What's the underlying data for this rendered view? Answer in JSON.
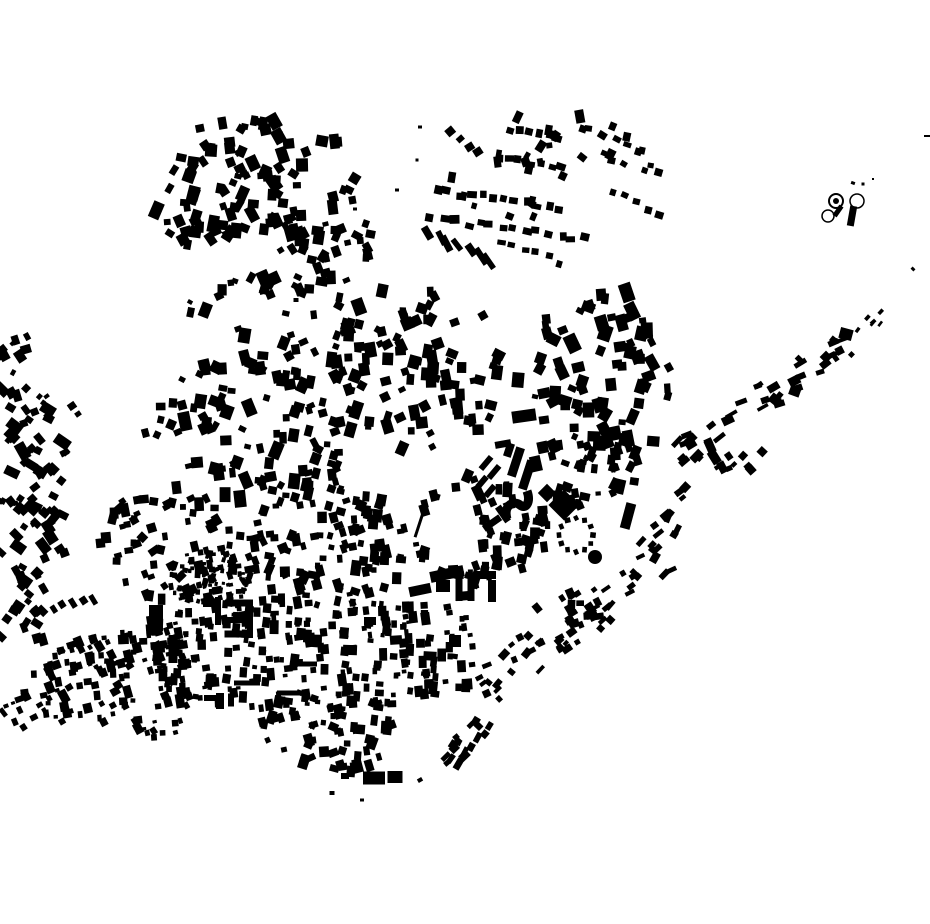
{
  "canvas": {
    "width": 930,
    "height": 924,
    "background": "#ffffff",
    "building_color": "#000000",
    "seed": 1337
  },
  "map": {
    "scatters": [
      {
        "shape": "ellipse",
        "cx": 255,
        "cy": 190,
        "rx": 105,
        "ry": 75,
        "n": 105,
        "smin": 6,
        "smax": 12,
        "ang": 0,
        "aj": 35
      },
      {
        "shape": "ellipse",
        "cx": 330,
        "cy": 240,
        "rx": 42,
        "ry": 36,
        "n": 22,
        "smin": 6,
        "smax": 11,
        "ang": 0,
        "aj": 35
      },
      {
        "shape": "ellipse",
        "cx": 545,
        "cy": 168,
        "rx": 115,
        "ry": 55,
        "n": 26,
        "smin": 5,
        "smax": 9,
        "ang": 10,
        "aj": 30
      },
      {
        "shape": "poly",
        "pts": [
          [
            0,
            330
          ],
          [
            28,
            332
          ],
          [
            62,
            432
          ],
          [
            76,
            520
          ],
          [
            60,
            640
          ],
          [
            0,
            640
          ]
        ],
        "n": 95,
        "smin": 5,
        "smax": 11,
        "ang": -40,
        "aj": 25
      },
      {
        "shape": "poly",
        "pts": [
          [
            8,
            700
          ],
          [
            70,
            638
          ],
          [
            185,
            618
          ],
          [
            192,
            744
          ],
          [
            25,
            716
          ]
        ],
        "n": 140,
        "smin": 4,
        "smax": 9,
        "ang": -15,
        "aj": 18
      },
      {
        "shape": "ellipse",
        "cx": 300,
        "cy": 330,
        "rx": 120,
        "ry": 58,
        "n": 55,
        "smin": 6,
        "smax": 12,
        "ang": 0,
        "aj": 30
      },
      {
        "shape": "ellipse",
        "cx": 255,
        "cy": 430,
        "rx": 110,
        "ry": 70,
        "n": 90,
        "smin": 6,
        "smax": 12,
        "ang": 0,
        "aj": 30
      },
      {
        "shape": "ellipse",
        "cx": 420,
        "cy": 370,
        "rx": 90,
        "ry": 80,
        "n": 85,
        "smin": 6,
        "smax": 12,
        "ang": 0,
        "aj": 30
      },
      {
        "shape": "ellipse",
        "cx": 600,
        "cy": 380,
        "rx": 72,
        "ry": 95,
        "n": 78,
        "smin": 6,
        "smax": 13,
        "ang": 0,
        "aj": 30
      },
      {
        "shape": "ellipse",
        "cx": 180,
        "cy": 545,
        "rx": 85,
        "ry": 60,
        "n": 70,
        "smin": 5,
        "smax": 10,
        "ang": -10,
        "aj": 25
      },
      {
        "shape": "ellipse",
        "cx": 210,
        "cy": 578,
        "rx": 46,
        "ry": 28,
        "n": 90,
        "smin": 3,
        "smax": 6,
        "ang": 0,
        "aj": 20
      },
      {
        "shape": "ellipse",
        "cx": 330,
        "cy": 545,
        "rx": 80,
        "ry": 65,
        "n": 105,
        "smin": 5,
        "smax": 10,
        "ang": 0,
        "aj": 25
      },
      {
        "shape": "ellipse",
        "cx": 480,
        "cy": 530,
        "rx": 70,
        "ry": 55,
        "n": 70,
        "smin": 5,
        "smax": 10,
        "ang": 0,
        "aj": 25,
        "hole": {
          "cx": 452,
          "cy": 530,
          "rx": 30,
          "ry": 33
        }
      },
      {
        "shape": "poly",
        "pts": [
          [
            148,
            612
          ],
          [
            250,
            598
          ],
          [
            360,
            600
          ],
          [
            470,
            608
          ],
          [
            478,
            660
          ],
          [
            468,
            700
          ],
          [
            300,
            712
          ],
          [
            165,
            705
          ],
          [
            146,
            660
          ]
        ],
        "n": 265,
        "smin": 4,
        "smax": 9,
        "ang": 0,
        "aj": 10
      },
      {
        "shape": "ellipse",
        "cx": 330,
        "cy": 730,
        "rx": 75,
        "ry": 45,
        "n": 65,
        "smin": 5,
        "smax": 10,
        "ang": 0,
        "aj": 25
      },
      {
        "shape": "ellipse",
        "cx": 590,
        "cy": 468,
        "rx": 55,
        "ry": 44,
        "n": 42,
        "smin": 5,
        "smax": 11,
        "ang": 0,
        "aj": 30
      },
      {
        "shape": "ellipse",
        "cx": 560,
        "cy": 602,
        "rx": 45,
        "ry": 33,
        "n": 16,
        "smin": 5,
        "smax": 9,
        "ang": -20,
        "aj": 25
      },
      {
        "shape": "ellipse",
        "cx": 735,
        "cy": 455,
        "rx": 28,
        "ry": 20,
        "n": 11,
        "smin": 5,
        "smax": 10,
        "ang": -30,
        "aj": 20
      }
    ],
    "bands": [
      {
        "x1": 670,
        "y1": 462,
        "x2": 852,
        "y2": 338,
        "hw": 14,
        "n": 40,
        "smin": 4,
        "smax": 11,
        "aj": 18
      },
      {
        "x1": 852,
        "y1": 338,
        "x2": 912,
        "y2": 286,
        "hw": 8,
        "n": 6,
        "smin": 3,
        "smax": 5,
        "aj": 20
      },
      {
        "x1": 698,
        "y1": 487,
        "x2": 645,
        "y2": 552,
        "hw": 14,
        "n": 14,
        "smin": 5,
        "smax": 10,
        "aj": 18
      },
      {
        "x1": 663,
        "y1": 556,
        "x2": 482,
        "y2": 688,
        "hw": 22,
        "n": 48,
        "smin": 4,
        "smax": 9,
        "aj": 15
      },
      {
        "x1": 497,
        "y1": 702,
        "x2": 446,
        "y2": 768,
        "hw": 12,
        "n": 16,
        "smin": 5,
        "smax": 10,
        "aj": 12
      }
    ],
    "rows": [
      {
        "x1": 452,
        "y1": 133,
        "x2": 478,
        "y2": 152,
        "n": 4,
        "w": 8,
        "h": 7,
        "jit": 2,
        "ang": -35,
        "aj": 10
      },
      {
        "x1": 512,
        "y1": 130,
        "x2": 558,
        "y2": 137,
        "n": 6,
        "w": 8,
        "h": 7,
        "jit": 2,
        "ang": 5,
        "aj": 12
      },
      {
        "x1": 498,
        "y1": 158,
        "x2": 562,
        "y2": 167,
        "n": 7,
        "w": 8,
        "h": 7,
        "jit": 2,
        "ang": 8,
        "aj": 12
      },
      {
        "x1": 580,
        "y1": 126,
        "x2": 640,
        "y2": 152,
        "n": 6,
        "w": 7,
        "h": 6,
        "jit": 4,
        "ang": 20,
        "aj": 15
      },
      {
        "x1": 600,
        "y1": 156,
        "x2": 655,
        "y2": 176,
        "n": 5,
        "w": 7,
        "h": 6,
        "jit": 4,
        "ang": 20,
        "aj": 15
      },
      {
        "x1": 437,
        "y1": 191,
        "x2": 560,
        "y2": 207,
        "n": 12,
        "w": 8,
        "h": 7,
        "jit": 3,
        "ang": 7,
        "aj": 10
      },
      {
        "x1": 432,
        "y1": 219,
        "x2": 585,
        "y2": 238,
        "n": 14,
        "w": 8,
        "h": 7,
        "jit": 3,
        "ang": 7,
        "aj": 10
      },
      {
        "x1": 428,
        "y1": 233,
        "x2": 490,
        "y2": 260,
        "n": 7,
        "w": 6,
        "h": 16,
        "jit": 3,
        "ang": -32,
        "aj": 8
      },
      {
        "x1": 500,
        "y1": 241,
        "x2": 560,
        "y2": 263,
        "n": 6,
        "w": 7,
        "h": 6,
        "jit": 3,
        "ang": 15,
        "aj": 12
      },
      {
        "x1": 610,
        "y1": 191,
        "x2": 660,
        "y2": 216,
        "n": 5,
        "w": 7,
        "h": 6,
        "jit": 3,
        "ang": 20,
        "aj": 12
      },
      {
        "x1": 33,
        "y1": 612,
        "x2": 92,
        "y2": 599,
        "n": 7,
        "w": 6,
        "h": 9,
        "jit": 2,
        "ang": -38,
        "aj": 8
      },
      {
        "x1": 4,
        "y1": 714,
        "x2": 22,
        "y2": 726,
        "n": 3,
        "w": 5,
        "h": 8,
        "jit": 2,
        "ang": -30,
        "aj": 8
      },
      {
        "x1": 122,
        "y1": 512,
        "x2": 205,
        "y2": 603,
        "n": 8,
        "w": 9,
        "h": 8,
        "jit": 5,
        "ang": -40,
        "aj": 15
      }
    ],
    "rects": [
      [
        322,
        141,
        12,
        11,
        10
      ],
      [
        337,
        142,
        10,
        10,
        -5
      ],
      [
        518,
        380,
        12,
        15,
        5
      ],
      [
        524,
        416,
        24,
        12,
        -8
      ],
      [
        544,
        420,
        10,
        8,
        -8
      ],
      [
        503,
        444,
        16,
        7,
        -10
      ],
      [
        420,
        522,
        3,
        32,
        18
      ],
      [
        516,
        462,
        9,
        30,
        18
      ],
      [
        527,
        475,
        9,
        30,
        18
      ],
      [
        509,
        450,
        8,
        14,
        18
      ],
      [
        486,
        463,
        6,
        16,
        40
      ],
      [
        494,
        472,
        6,
        16,
        40
      ],
      [
        482,
        482,
        6,
        14,
        40
      ],
      [
        490,
        491,
        6,
        14,
        40
      ],
      [
        564,
        505,
        22,
        22,
        45
      ],
      [
        547,
        493,
        13,
        13,
        45
      ],
      [
        567,
        487,
        10,
        9,
        20
      ],
      [
        628,
        516,
        10,
        26,
        15
      ],
      [
        492,
        523,
        20,
        7,
        -35
      ],
      [
        503,
        514,
        7,
        18,
        -35
      ],
      [
        459,
        587,
        7,
        28,
        0
      ],
      [
        471,
        587,
        7,
        28,
        0
      ],
      [
        486,
        575,
        20,
        8,
        0
      ],
      [
        492,
        591,
        8,
        22,
        0
      ],
      [
        443,
        586,
        14,
        12,
        0
      ],
      [
        447,
        574,
        34,
        11,
        -12
      ],
      [
        420,
        590,
        22,
        10,
        -12
      ],
      [
        463,
        596,
        14,
        9,
        -5
      ],
      [
        239,
        603,
        28,
        7,
        0
      ],
      [
        239,
        620,
        24,
        6,
        0
      ],
      [
        238,
        634,
        27,
        7,
        0
      ],
      [
        250,
        619,
        6,
        38,
        0
      ],
      [
        218,
        611,
        6,
        28,
        0
      ],
      [
        209,
        604,
        12,
        6,
        0
      ],
      [
        173,
        649,
        9,
        28,
        0
      ],
      [
        186,
        664,
        10,
        8,
        0
      ],
      [
        156,
        618,
        14,
        26,
        0
      ],
      [
        374,
        778,
        22,
        13,
        0
      ],
      [
        395,
        777,
        15,
        12,
        0
      ],
      [
        345,
        776,
        8,
        6,
        0
      ],
      [
        846,
        334,
        13,
        11,
        15
      ],
      [
        826,
        357,
        9,
        9,
        45
      ],
      [
        795,
        391,
        11,
        10,
        20
      ],
      [
        779,
        401,
        5,
        5,
        0
      ],
      [
        838,
        211,
        5,
        12,
        35
      ],
      [
        852,
        216,
        7,
        20,
        10
      ],
      [
        853,
        183,
        4,
        3,
        20
      ],
      [
        863,
        184,
        3,
        3,
        0
      ],
      [
        873,
        179,
        2,
        2,
        0
      ],
      [
        927,
        136,
        6,
        2,
        0
      ],
      [
        913,
        269,
        4,
        3,
        45
      ],
      [
        350,
        650,
        14,
        10,
        2
      ],
      [
        396,
        640,
        12,
        9,
        -4
      ],
      [
        430,
        656,
        13,
        9,
        3
      ],
      [
        455,
        641,
        12,
        12,
        0
      ],
      [
        370,
        621,
        12,
        8,
        0
      ],
      [
        247,
        683,
        26,
        5,
        0
      ],
      [
        292,
        693,
        30,
        5,
        0
      ],
      [
        214,
        698,
        20,
        6,
        0
      ],
      [
        306,
        664,
        22,
        5,
        0
      ],
      [
        220,
        701,
        8,
        16,
        0
      ],
      [
        231,
        700,
        6,
        13,
        0
      ],
      [
        235,
        281,
        6,
        5,
        20
      ],
      [
        262,
        292,
        5,
        5,
        -15
      ],
      [
        296,
        300,
        5,
        4,
        0
      ],
      [
        190,
        302,
        5,
        4,
        30
      ],
      [
        355,
        209,
        4,
        3,
        0
      ],
      [
        397,
        190,
        4,
        3,
        0
      ],
      [
        417,
        160,
        3,
        3,
        0
      ],
      [
        420,
        127,
        4,
        3,
        0
      ],
      [
        72,
        406,
        8,
        7,
        -35
      ],
      [
        78,
        414,
        6,
        5,
        -35
      ],
      [
        66,
        452,
        7,
        6,
        -40
      ],
      [
        6,
        706,
        5,
        4,
        -20
      ],
      [
        13,
        703,
        4,
        3,
        -20
      ],
      [
        332,
        793,
        5,
        4,
        0
      ],
      [
        362,
        800,
        4,
        3,
        0
      ],
      [
        420,
        780,
        5,
        4,
        -30
      ],
      [
        447,
        763,
        6,
        5,
        -40
      ],
      [
        456,
        737,
        6,
        5,
        -40
      ]
    ],
    "circles": [
      {
        "cx": 595,
        "cy": 557,
        "r": 7,
        "type": "fill",
        "sw": 0
      },
      {
        "cx": 836,
        "cy": 201,
        "r": 7,
        "type": "ring",
        "sw": 2
      },
      {
        "cx": 836,
        "cy": 201,
        "r": 3,
        "type": "fill",
        "sw": 0
      },
      {
        "cx": 857,
        "cy": 201,
        "r": 7,
        "type": "ring",
        "sw": 1.5
      },
      {
        "cx": 828,
        "cy": 216,
        "r": 6,
        "type": "ring",
        "sw": 1.5
      }
    ],
    "dot_ring": {
      "cx": 576,
      "cy": 535,
      "r": 17,
      "count": 12,
      "dot": 5
    },
    "paths": [
      {
        "d": "M 507 519 C 503 505 514 500 520 505 C 526 510 531 502 527 491",
        "sw": 9
      }
    ]
  }
}
